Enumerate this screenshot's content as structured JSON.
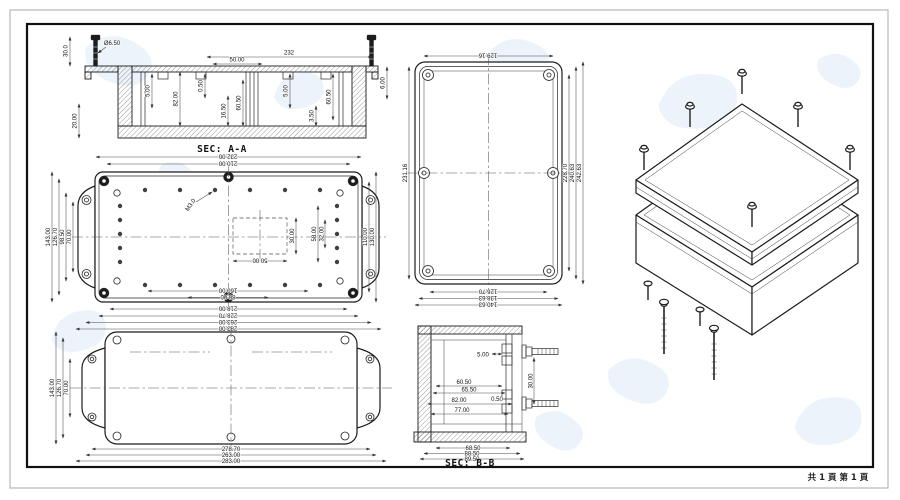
{
  "sheet": {
    "page_footer": "共 1 頁  第 1 頁"
  },
  "views": {
    "sec_aa": {
      "label": "SEC: A-A",
      "dims": {
        "stud_height": "30.0",
        "stud_dia": "Ø6.50",
        "overall": "232",
        "center_span": "50.00",
        "rib_left": "5.00",
        "lip": "0.50",
        "depth_total": "82.00",
        "boss_depth": "16.50",
        "depth_mid": "60.50",
        "rib_right": "5.00",
        "depth_right": "60.50",
        "floor": "3.50",
        "wall_bottom": "20.00",
        "flange_edge": "6.00"
      }
    },
    "base_plan": {
      "thread_note": "M3.0",
      "dims": {
        "top_a": "232.00",
        "top_b": "210.00",
        "bottom_a": "218.00",
        "bottom_b": "228.70",
        "bottom_c": "263.00",
        "bottom_d": "283.00",
        "left_a": "143.00",
        "left_b": "126.70",
        "left_c": "98.50",
        "left_d": "70.00",
        "right_a": "110.00",
        "right_b": "130.00",
        "holes_v_a": "58.00",
        "holes_v_b": "32.00",
        "pocket_w": "50.00",
        "pocket_h": "30.00",
        "holes_h_a": "160.00",
        "holes_h_b": "80.00"
      }
    },
    "lid_plan": {
      "dims": {
        "top": "129.16",
        "left": "231.16",
        "right_a": "228.70",
        "right_b": "240.63",
        "right_c": "242.63",
        "bottom_a": "126.70",
        "bottom_b": "138.63",
        "bottom_c": "140.63"
      }
    },
    "flange_plan": {
      "dims": {
        "left_a": "143.00",
        "left_b": "126.70",
        "left_c": "70.00",
        "bottom_a": "278.70",
        "bottom_b": "263.00",
        "bottom_c": "283.00"
      }
    },
    "sec_bb": {
      "label": "SEC: B-B",
      "dims": {
        "boss": "5.00",
        "depth_a": "60.50",
        "depth_b": "65.50",
        "depth_c": "82.00",
        "lip": "0.50",
        "depth_d": "77.00",
        "screw_span": "30.00",
        "bottom_a": "68.50",
        "bottom_b": "88.50",
        "bottom_c": "89.50"
      }
    }
  }
}
